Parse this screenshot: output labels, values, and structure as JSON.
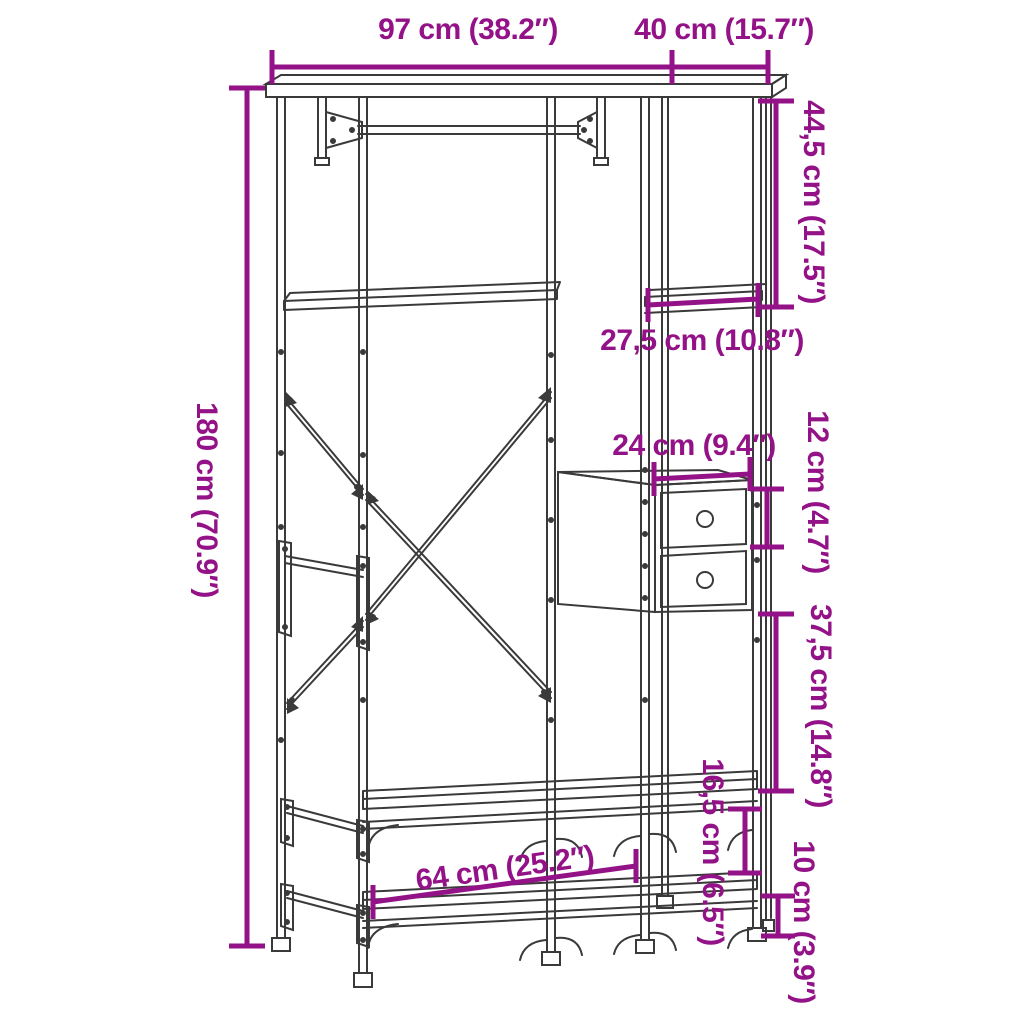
{
  "diagram_type": "furniture-dimension-drawing",
  "product": "clothes rack with shelves and drawers",
  "colors": {
    "dimension": "#941287",
    "line_art": "#3a3a3a",
    "background": "#ffffff"
  },
  "dims": {
    "width_top": "97 cm (38.2″)",
    "depth_top": "40 cm (15.7″)",
    "height_total": "180 cm (70.9″)",
    "top_cubby_height": "44,5 cm (17.5″)",
    "side_shelf_width": "27,5 cm (10.8″)",
    "drawer_unit_width": "24 cm (9.4″)",
    "drawer_height": "12 cm (4.7″)",
    "under_drawer_gap": "37,5 cm (14.8″)",
    "bottom_shelf_gap": "16,5 cm (6.5″)",
    "bottom_clearance": "10 cm (3.9″)",
    "bench_span": "64 cm (25.2″)"
  }
}
